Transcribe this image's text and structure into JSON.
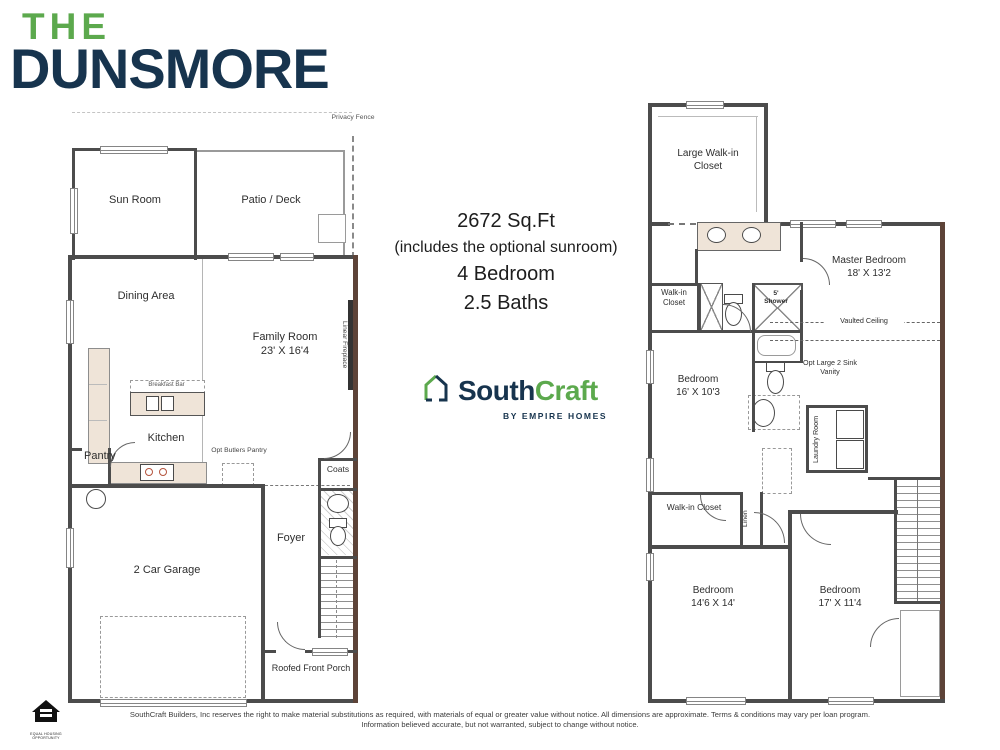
{
  "title": {
    "prefix": "THE",
    "name": "DUNSMORE"
  },
  "summary": {
    "sqft": "2672 Sq.Ft",
    "note": "(includes the optional sunroom)",
    "beds": "4 Bedroom",
    "baths": "2.5 Baths"
  },
  "brand": {
    "name_a": "South",
    "name_b": "Craft",
    "tagline": "BY EMPIRE HOMES"
  },
  "colors": {
    "green": "#5ca94d",
    "navy": "#17344e",
    "wall": "#4c4c4c",
    "accent_wall": "#5d4338"
  },
  "floor1": {
    "privacy_fence": "Privacy Fence",
    "sun_room": "Sun Room",
    "patio": "Patio / Deck",
    "dining": "Dining Area",
    "family": "Family Room",
    "family_dim": "23' X 16'4",
    "linear_fireplace": "Linear Fireplace",
    "breakfast_bar": "Breakfast Bar",
    "kitchen": "Kitchen",
    "pantry": "Pantry",
    "opt_butlers": "Opt Butlers Pantry",
    "coats": "Coats",
    "foyer": "Foyer",
    "garage": "2 Car Garage",
    "porch": "Roofed Front Porch"
  },
  "floor2": {
    "large_wic": "Large Walk-in Closet",
    "master": "Master Bedroom",
    "master_dim": "18' X 13'2",
    "wic": "Walk-in Closet",
    "shower_size": "5'",
    "shower": "Shower",
    "vaulted": "Vaulted Ceiling",
    "bed2": "Bedroom",
    "bed2_dim": "16' X 10'3",
    "opt_vanity": "Opt Large 2 Sink Vanity",
    "laundry": "Laundry Room",
    "wic2": "Walk-in Closet",
    "linen": "Linen",
    "bed3": "Bedroom",
    "bed3_dim": "14'6 X 14'",
    "bed4": "Bedroom",
    "bed4_dim": "17' X 11'4"
  },
  "disclaimer": {
    "line1": "SouthCraft Builders, Inc reserves the right to make material substitutions as required, with materials of equal or greater value without notice. All dimensions are approximate. Terms & conditions may vary per loan program.",
    "line2": "Information believed accurate, but not warranted, subject to change without notice."
  },
  "footer": {
    "eho_line1": "EQUAL HOUSING",
    "eho_line2": "OPPORTUNITY"
  }
}
